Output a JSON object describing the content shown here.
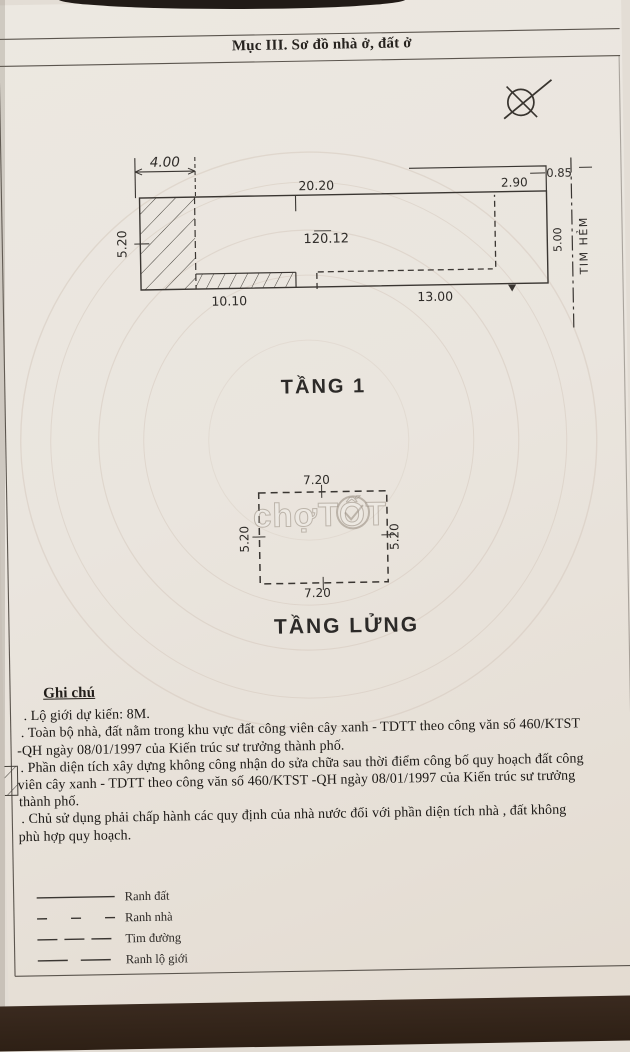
{
  "page_title": "Mục III. Sơ đồ nhà ở, đất ở",
  "floor1": {
    "name": "TẦNG 1",
    "area_label": "120.12",
    "dim_top_left": "4.00",
    "dim_top": "20.20",
    "dim_top_right": "2.90",
    "dim_offset_right": "0.85",
    "dim_left": "5.20",
    "dim_right": "5.00",
    "dim_bottom_left": "10.10",
    "dim_bottom_right": "13.00",
    "alley_centerline_label": "TIM HẺM"
  },
  "mezzanine": {
    "name": "TẦNG LỬNG",
    "dim_top": "7.20",
    "dim_bottom": "7.20",
    "dim_left": "5.20",
    "dim_right": "5.20"
  },
  "notes": {
    "heading": "Ghi chú",
    "lines": [
      ". Lộ giới dự kiến: 8M.",
      ". Toàn bộ nhà, đất nằm trong khu vực đất công viên cây xanh - TDTT theo công văn số 460/KTST",
      "-QH ngày 08/01/1997 của Kiến trúc sư trưởng thành phố.",
      ". Phần diện tích xây dựng không công nhận do sửa chữa sau thời điểm công bố quy hoạch đất công",
      "viên cây xanh - TDTT theo công văn số 460/KTST -QH ngày 08/01/1997 của Kiến trúc sư trưởng",
      "thành phố.",
      ". Chủ sử dụng phải chấp hành các quy định của nhà nước đối với phần diện tích nhà , đất không",
      "phù hợp quy hoạch."
    ]
  },
  "legend": {
    "items": [
      {
        "label": "Ranh đất",
        "line_style": "solid"
      },
      {
        "label": "Ranh nhà",
        "line_style": "sparse-dash"
      },
      {
        "label": "Tim đường",
        "line_style": "dash"
      },
      {
        "label": "Ranh lộ giới",
        "line_style": "long-dash"
      }
    ]
  },
  "watermark_text": "chợTỐT",
  "colors": {
    "paper": "#eae5de",
    "ink": "#37342f",
    "photo_background": "#31221a"
  }
}
